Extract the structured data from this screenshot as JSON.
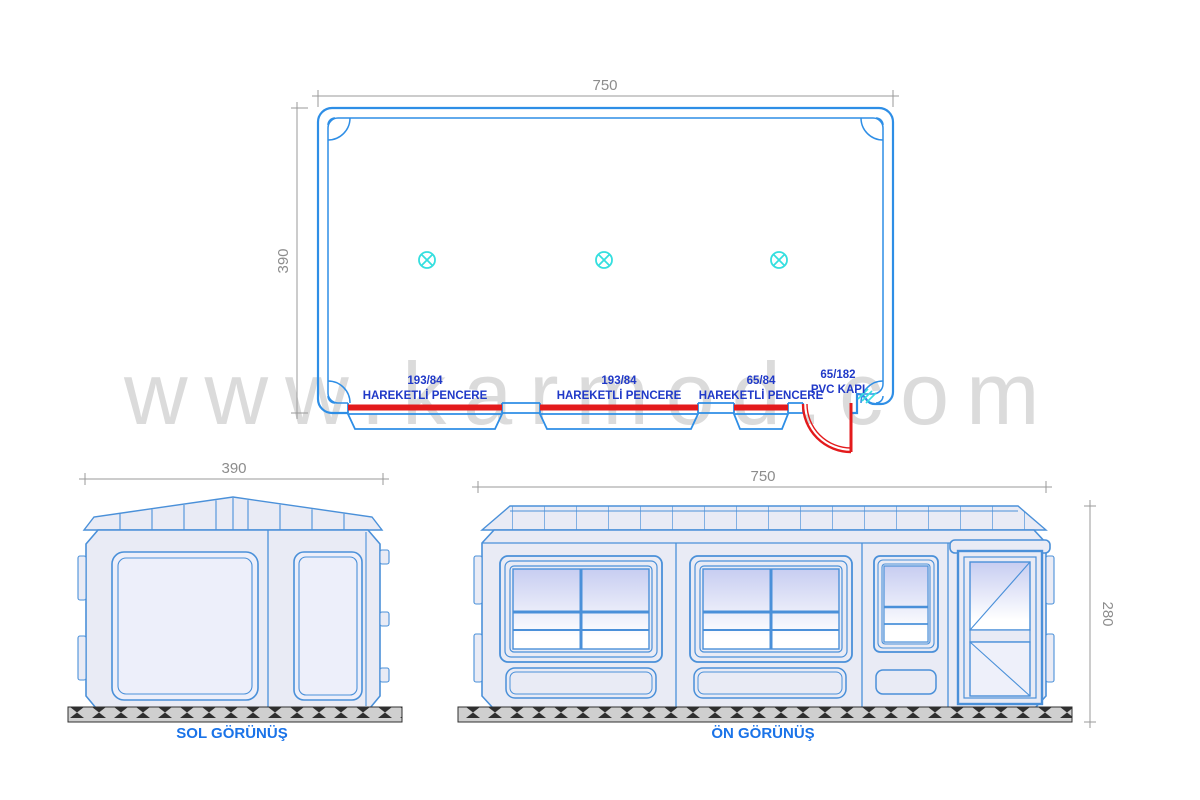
{
  "watermark": "www.karmod.com",
  "plan_view": {
    "width_dim": "750",
    "depth_dim": "390",
    "openings": [
      {
        "size": "193/84",
        "label": "HAREKETLİ  PENCERE"
      },
      {
        "size": "193/84",
        "label": "HAREKETLİ  PENCERE"
      },
      {
        "size": "65/84",
        "label": "HAREKETLİ  PENCERE"
      },
      {
        "size": "65/182",
        "label": "PVC KAPI"
      }
    ]
  },
  "left_view": {
    "title": "SOL GÖRÜNÜŞ",
    "width_dim": "390"
  },
  "front_view": {
    "title": "ÖN GÖRÜNÜŞ",
    "width_dim": "750",
    "height_dim": "280"
  },
  "colors": {
    "wall_blue": "#2e8ee6",
    "elevation_blue": "#4a90d9",
    "accent_red": "#e31a1c",
    "lamp_cyan": "#35dfdf",
    "label_blue": "#2039c8",
    "title_blue": "#1a73e8",
    "dim_gray": "#8c8c8c",
    "panel_fill": "#e9ebf5",
    "glass_top": "#c7cdf1",
    "watermark_gray": "#dbdbdb"
  }
}
